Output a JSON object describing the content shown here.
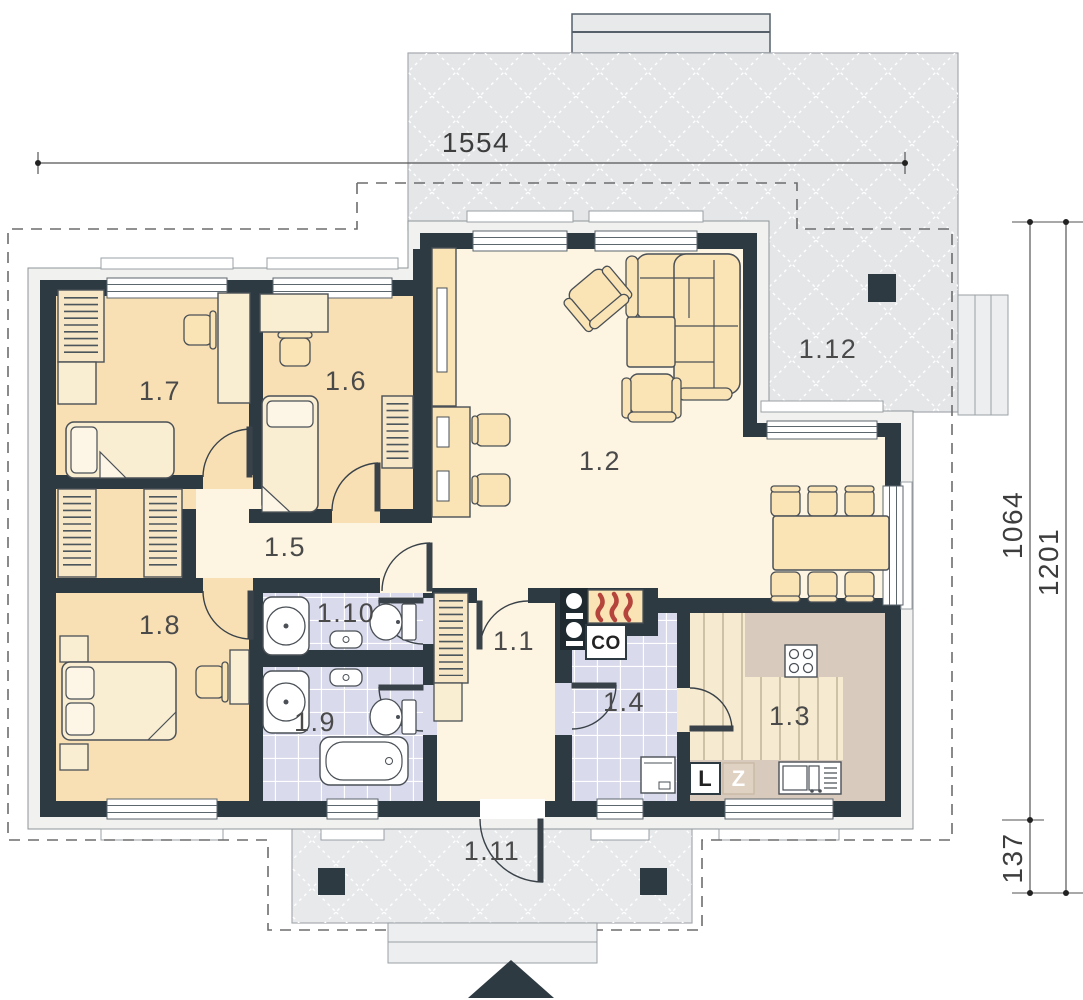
{
  "rooms": {
    "hall": "1.1",
    "living": "1.2",
    "kitchen": "1.3",
    "utility": "1.4",
    "corridor": "1.5",
    "bedroom_small": "1.6",
    "bedroom_child": "1.7",
    "bedroom_master": "1.8",
    "bathroom": "1.9",
    "wc": "1.10",
    "porch": "1.11",
    "terrace": "1.12"
  },
  "dimensions": {
    "top_width": "1554",
    "right_house_depth": "1064",
    "right_total_depth": "1201",
    "right_porch_offset": "137"
  },
  "markers": {
    "boiler": "CO",
    "fridge": "L",
    "freezer": "Z"
  },
  "colors": {
    "wall": "#2d3a42",
    "bedroom_floor": "#f8e0b4",
    "living_floor": "#fdf5e2",
    "bath_floor": "#d9daec",
    "terrace": "#e4e6e8",
    "porch": "#e7e9eb",
    "kitchen_floor": "#f6ead0",
    "counter": "#d8cbbd",
    "furniture": "#fae3b4",
    "flame": "#b5443c",
    "facade": "#f1f1ef"
  }
}
